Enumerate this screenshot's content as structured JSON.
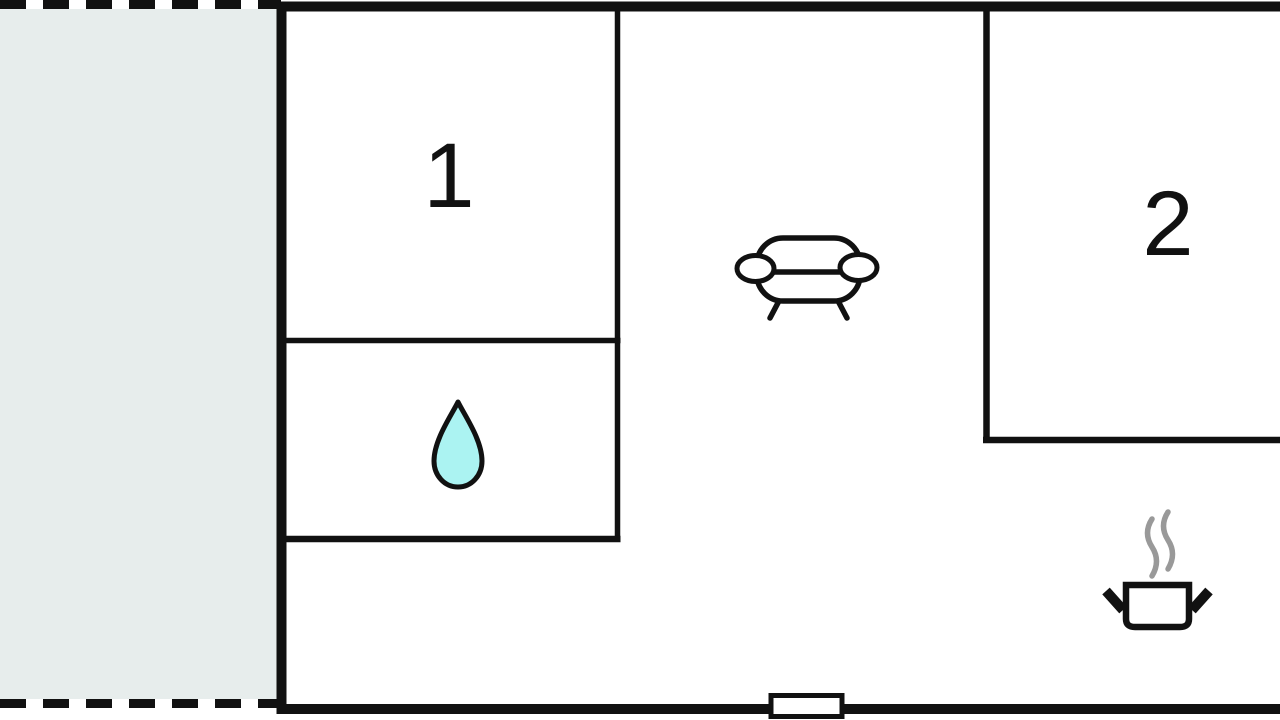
{
  "rooms": [
    {
      "label": "1"
    },
    {
      "label": "2"
    }
  ],
  "colors": {
    "wall": "#111111",
    "terrace_fill": "#e7edec",
    "room_fill": "#ffffff",
    "water_drop_fill": "#abf3f2",
    "steam": "#999999"
  },
  "icons": {
    "water_drop": "water-drop-icon",
    "sofa": "sofa-icon",
    "cooking_pot": "cooking-pot-icon",
    "entrance": "door-opening"
  }
}
